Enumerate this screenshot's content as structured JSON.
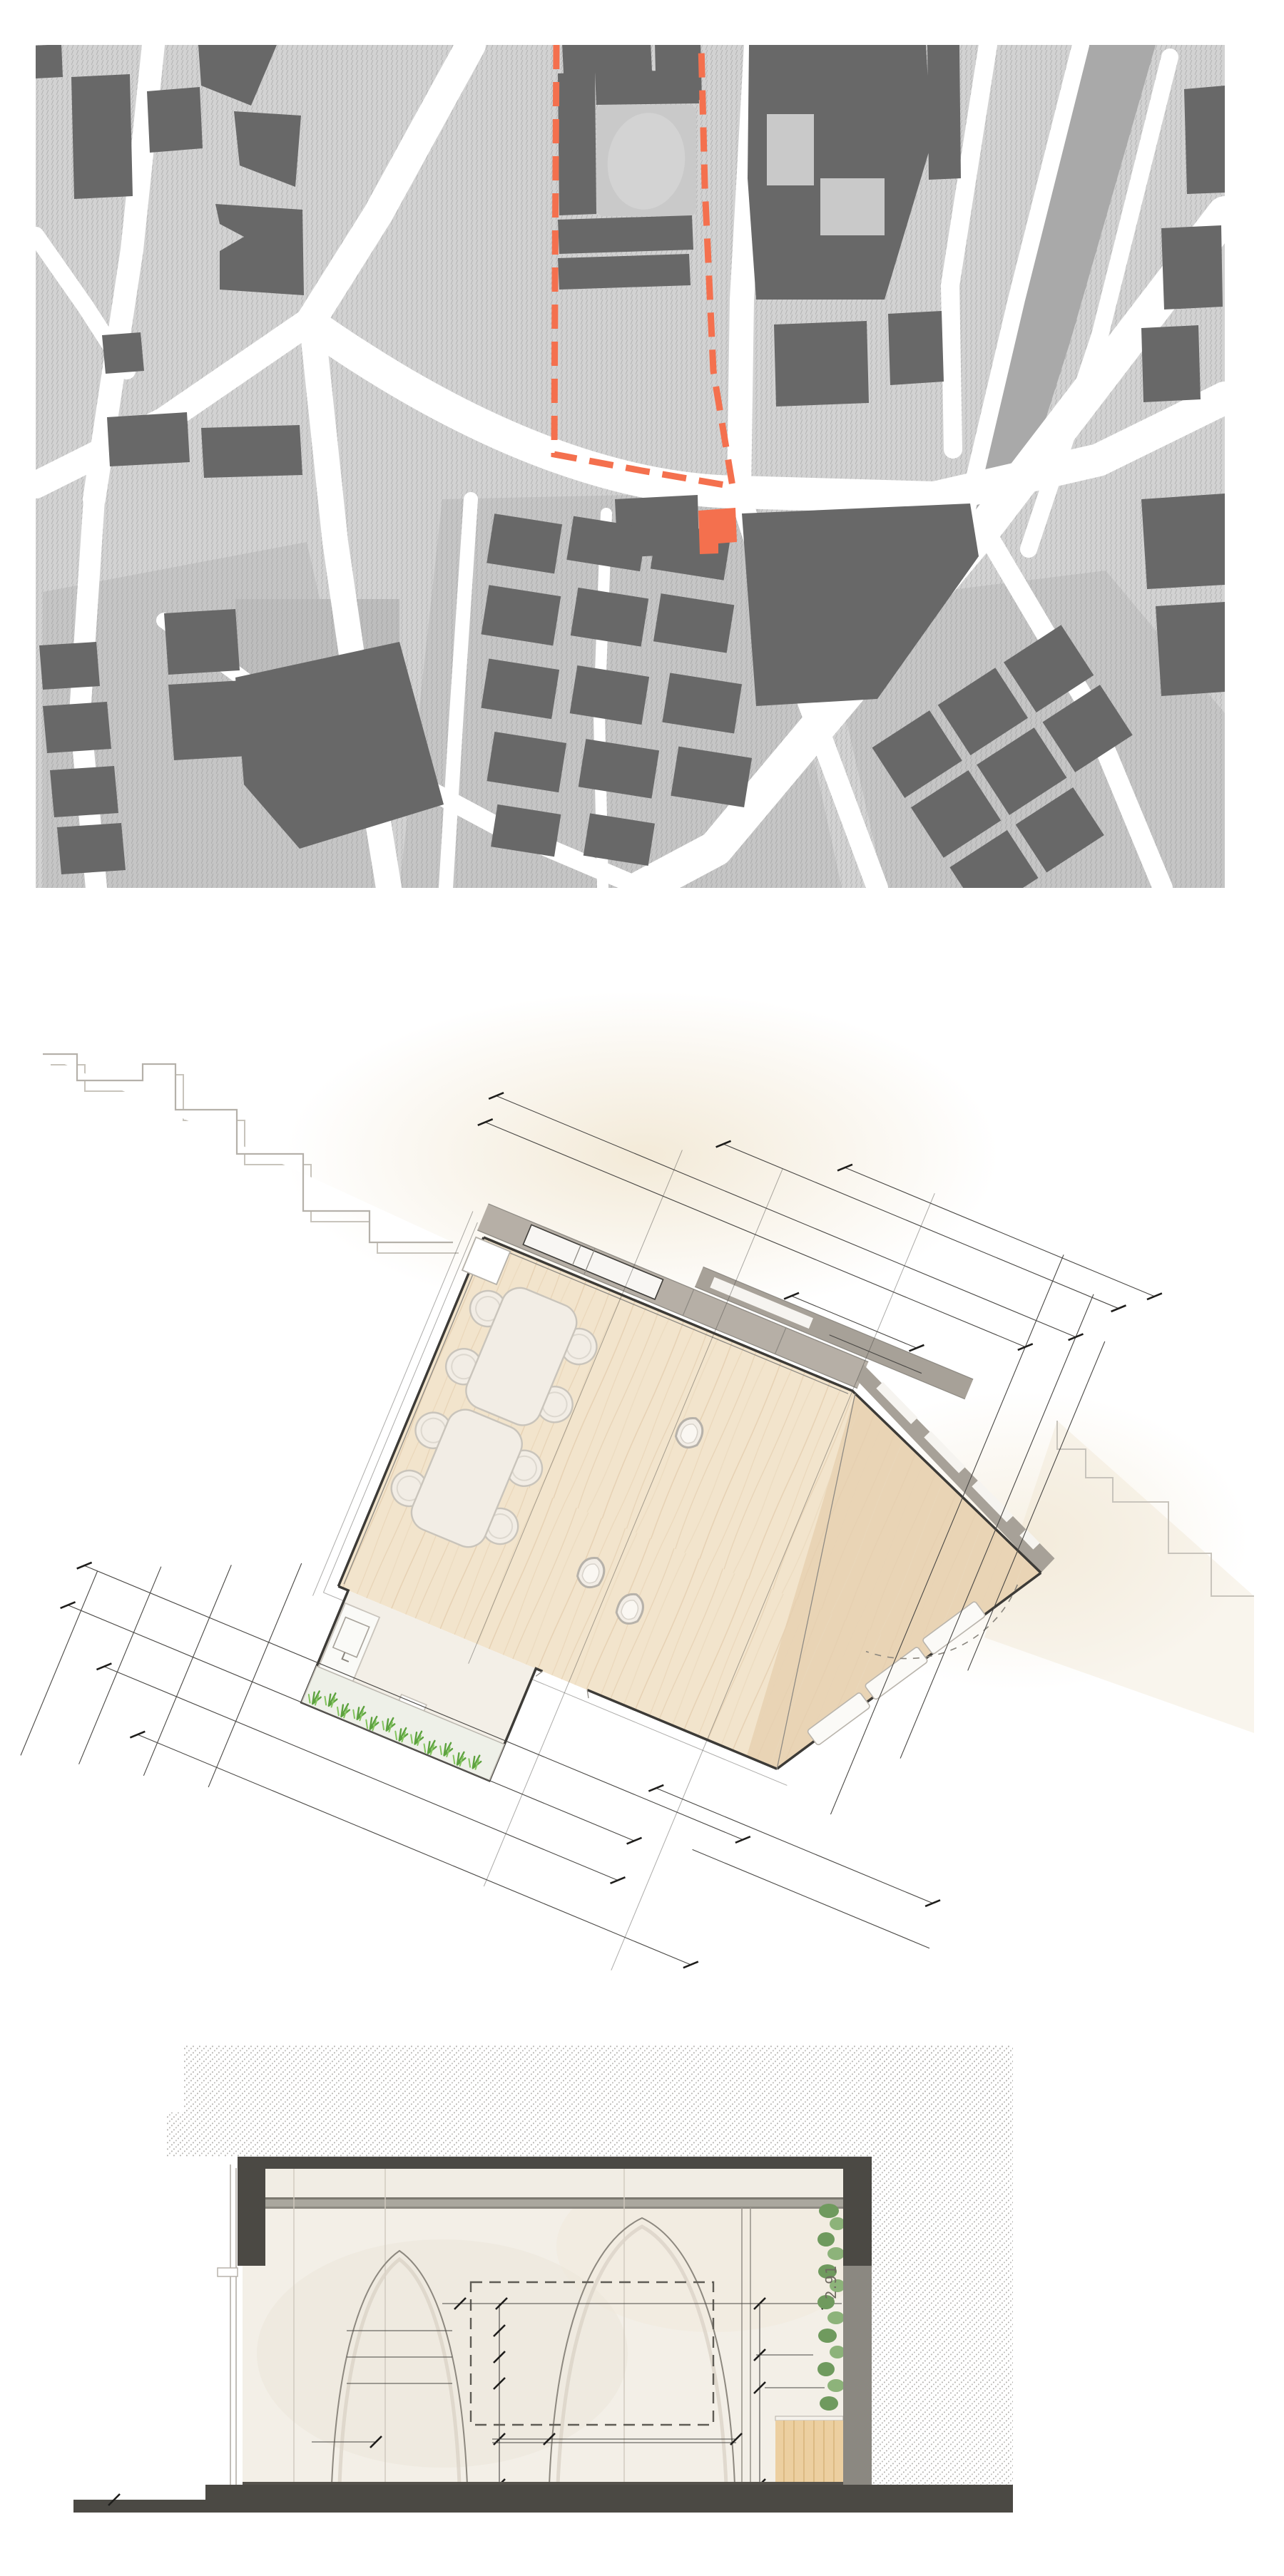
{
  "document": {
    "type": "architectural presentation sheet",
    "panels": [
      {
        "id": "site-plan",
        "label": "site location map",
        "features": [
          "street network",
          "building blocks",
          "site boundary (red dashed)",
          "project building (red)"
        ]
      },
      {
        "id": "floor-plan",
        "label": "ground floor plan",
        "features": [
          "wood floor",
          "two dining tables with chairs",
          "three stools",
          "glazed street facade",
          "angled bay",
          "planter with grass",
          "kitchen counter",
          "dimension grid"
        ]
      },
      {
        "id": "section",
        "label": "cross section",
        "features": [
          "hatched ground",
          "dark cut roof and slab",
          "large arch",
          "small arch with shelves",
          "dashed screen outline",
          "plant wall",
          "wood cabinet"
        ]
      }
    ]
  },
  "annotations": {
    "dim_label": "2.91"
  },
  "counts": {
    "dining_tables": 2,
    "chairs": 8,
    "stools": 3,
    "arches": 2,
    "site_boundary_sides": 3
  },
  "colors": {
    "map_base": "#d2d2d2",
    "map_building": "#686868",
    "map_block_shade": "#c5c5c5",
    "map_street": "#ffffff",
    "map_park": "#a9a9a9",
    "site_red": "#f4704e",
    "plan_wood": "#f2e4cc",
    "plan_wood_dark": "#e9d4b5",
    "plan_glazing_band": "#b6afa6",
    "plan_glazing_band_dark": "#a7a198",
    "plan_wall": "#3d3b37",
    "plan_context_line": "#b5b1aa",
    "plan_grass": "#5da23f",
    "furniture_white": "#f2ede5",
    "furniture_outline": "#c9c4bb",
    "section_dark": "#4b4944",
    "section_wall_cream": "#f3efe7",
    "section_wall_line": "#cfc9bd",
    "section_gray_wall": "#8b8881",
    "plant_green": "#6f9a5e",
    "cabinet_wood": "#eccfa0",
    "dim_line": "#4a4845"
  }
}
